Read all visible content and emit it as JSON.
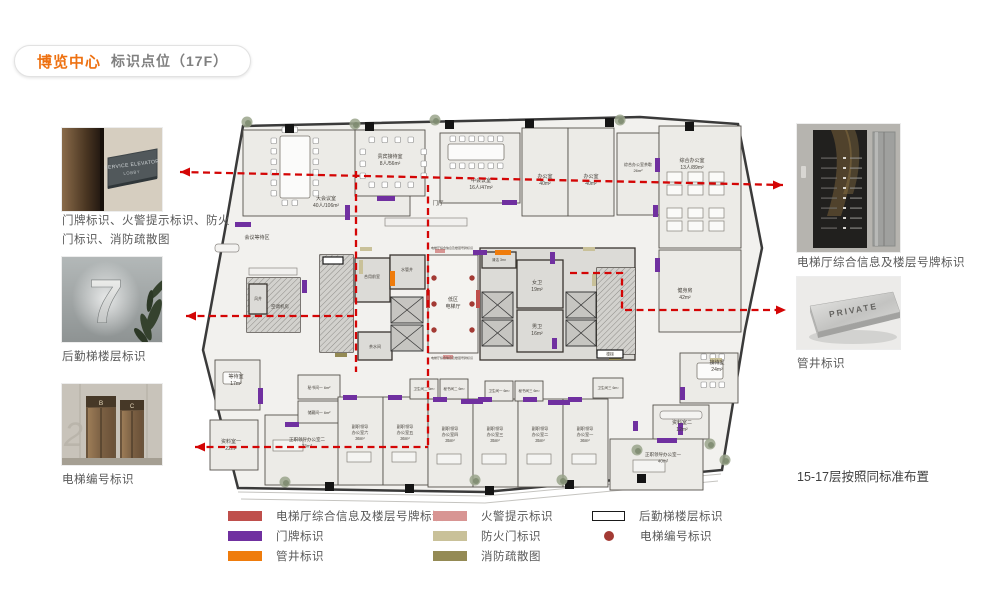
{
  "title": {
    "brand": "博览中心",
    "subtitle": "标识点位（17F）"
  },
  "left_column": [
    {
      "caption": "门牌标识、火警提示标识、防火门标识、消防疏散图"
    },
    {
      "caption": "后勤梯楼层标识"
    },
    {
      "caption": "电梯编号标识"
    }
  ],
  "right_column": {
    "items": [
      {
        "caption": "电梯厅综合信息及楼层号牌标识"
      },
      {
        "caption": "管井标识"
      }
    ],
    "note": "15-17层按照同标准布置"
  },
  "photos": {
    "p1": {
      "sign_line1": "SERVICE ELEVATOR",
      "sign_line2": "LOBBY"
    },
    "p2": {
      "numeral": "7"
    },
    "p3": {
      "left_door": "B",
      "right_door": "C",
      "wall_numeral": "2"
    },
    "r2": {
      "plate": "PRIVATE"
    }
  },
  "colors": {
    "purple": "#7030a0",
    "orange": "#ef7c0c",
    "pink": "#d89593",
    "khaki": "#c9c199",
    "olive": "#948a54",
    "red": "#bf4f4c",
    "dot": "#a33a34",
    "line": "#d40505",
    "wall": "#3a3a3a",
    "roomfill": "#ecebe7",
    "corefill": "#dcdbd7",
    "labeltext": "#46423c"
  },
  "legend": {
    "columns": [
      [
        {
          "type": "rect",
          "color": "#bf4f4c",
          "label": "电梯厅综合信息及楼层号牌标识"
        },
        {
          "type": "rect",
          "color": "#7030a0",
          "label": "门牌标识"
        },
        {
          "type": "rect",
          "color": "#ef7c0c",
          "label": "管井标识"
        }
      ],
      [
        {
          "type": "rect",
          "color": "#d89593",
          "label": "火警提示标识"
        },
        {
          "type": "rect",
          "color": "#c9c199",
          "label": "防火门标识"
        },
        {
          "type": "rect",
          "color": "#948a54",
          "label": "消防疏散图"
        }
      ],
      [
        {
          "type": "outline",
          "color": "#ffffff",
          "label": "后勤梯楼层标识"
        },
        {
          "type": "dot",
          "color": "#a33a34",
          "label": "电梯编号标识"
        }
      ]
    ],
    "col_left": [
      228,
      433,
      592
    ]
  },
  "floorplan": {
    "outline": "58,18 455,9 553,16 577,140 560,222 537,362 300,384 53,380 18,242 40,122",
    "extras": [
      "M53,384 L300,388 L536,366",
      "M56,391 L300,395 L533,373"
    ],
    "rooms": [
      {
        "x": 58,
        "y": 22,
        "w": 167,
        "h": 86,
        "lines": [
          "大会议室",
          "40人/106m²"
        ],
        "lx": 141,
        "ly": 92
      },
      {
        "x": 170,
        "y": 22,
        "w": 70,
        "h": 66,
        "lines": [
          "贵宾接待室",
          "8人/56m²"
        ],
        "lx": 205,
        "ly": 50
      },
      {
        "x": 255,
        "y": 25,
        "w": 80,
        "h": 70,
        "lines": [
          "中会议室",
          "16人/47m²"
        ],
        "lx": 296,
        "ly": 74
      },
      {
        "x": 337,
        "y": 20,
        "w": 46,
        "h": 88,
        "lines": [
          "办公室",
          "40m²"
        ],
        "lx": 360,
        "ly": 70
      },
      {
        "x": 383,
        "y": 20,
        "w": 46,
        "h": 88,
        "lines": [
          "办公室",
          "40m²"
        ],
        "lx": 406,
        "ly": 70
      },
      {
        "x": 432,
        "y": 25,
        "w": 42,
        "h": 82,
        "lines": [
          "综合办公室茶歇",
          "26m²"
        ],
        "lx": 453,
        "ly": 58,
        "fs": 4
      },
      {
        "x": 474,
        "y": 18,
        "w": 82,
        "h": 122,
        "lines": [
          "综合办公室",
          "13人/89m²"
        ],
        "lx": 507,
        "ly": 54
      },
      {
        "x": 474,
        "y": 142,
        "w": 82,
        "h": 82,
        "lines": [
          "健身房",
          "42m²"
        ],
        "lx": 500,
        "ly": 184
      },
      {
        "x": 495,
        "y": 245,
        "w": 58,
        "h": 50,
        "lines": [
          "接待室",
          "24m²"
        ],
        "lx": 532,
        "ly": 256
      },
      {
        "x": 468,
        "y": 297,
        "w": 56,
        "h": 34,
        "lines": [
          "资料室二",
          "12m²"
        ],
        "lx": 497,
        "ly": 316
      },
      {
        "x": 425,
        "y": 331,
        "w": 93,
        "h": 51,
        "lines": [
          "正职领导办公室一",
          "40m²"
        ],
        "lx": 478,
        "ly": 348,
        "fs": 4.5
      },
      {
        "x": 80,
        "y": 307,
        "w": 90,
        "h": 70,
        "lines": [
          "正职领导办公室二",
          "73m²"
        ],
        "lx": 122,
        "ly": 333,
        "fs": 4.5
      },
      {
        "x": 25,
        "y": 312,
        "w": 48,
        "h": 50,
        "lines": [
          "资料室一",
          "22m²"
        ],
        "lx": 46,
        "ly": 335
      },
      {
        "x": 30,
        "y": 252,
        "w": 45,
        "h": 50,
        "lines": [
          "等待室",
          "17m²"
        ],
        "lx": 51,
        "ly": 270
      },
      {
        "x": 113,
        "y": 267,
        "w": 42,
        "h": 24,
        "lines": [
          "秘书间一 6m²"
        ],
        "lx": 134,
        "ly": 281,
        "fs": 3.8
      },
      {
        "x": 113,
        "y": 293,
        "w": 42,
        "h": 22,
        "lines": [
          "储藏间一 6m²"
        ],
        "lx": 134,
        "ly": 306,
        "fs": 3.8
      },
      {
        "x": 153,
        "y": 289,
        "w": 45,
        "h": 88,
        "lines": [
          "副职领导",
          "办公室六",
          "36m²"
        ],
        "lx": 175,
        "ly": 320,
        "fs": 4.2
      },
      {
        "x": 198,
        "y": 289,
        "w": 45,
        "h": 88,
        "lines": [
          "副职领导",
          "办公室五",
          "36m²"
        ],
        "lx": 220,
        "ly": 320,
        "fs": 4.2
      },
      {
        "x": 243,
        "y": 291,
        "w": 45,
        "h": 88,
        "lines": [
          "副职领导",
          "办公室四",
          "35m²"
        ],
        "lx": 265,
        "ly": 322,
        "fs": 4.2
      },
      {
        "x": 288,
        "y": 291,
        "w": 45,
        "h": 88,
        "lines": [
          "副职领导",
          "办公室三",
          "35m²"
        ],
        "lx": 310,
        "ly": 322,
        "fs": 4.2
      },
      {
        "x": 333,
        "y": 291,
        "w": 45,
        "h": 88,
        "lines": [
          "副职领导",
          "办公室二",
          "35m²"
        ],
        "lx": 355,
        "ly": 322,
        "fs": 4.2
      },
      {
        "x": 378,
        "y": 291,
        "w": 45,
        "h": 88,
        "lines": [
          "副职领导",
          "办公室一",
          "36m²"
        ],
        "lx": 400,
        "ly": 322,
        "fs": 4.2
      },
      {
        "x": 225,
        "y": 271,
        "w": 28,
        "h": 20,
        "lines": [
          "卫生间二 6m²"
        ],
        "lx": 239,
        "ly": 282,
        "fs": 3.5
      },
      {
        "x": 255,
        "y": 271,
        "w": 28,
        "h": 20,
        "lines": [
          "秘书间二 6m²"
        ],
        "lx": 269,
        "ly": 282,
        "fs": 3.5
      },
      {
        "x": 300,
        "y": 273,
        "w": 28,
        "h": 20,
        "lines": [
          "卫生间一 6m²"
        ],
        "lx": 314,
        "ly": 284,
        "fs": 3.5
      },
      {
        "x": 330,
        "y": 273,
        "w": 28,
        "h": 20,
        "lines": [
          "秘书间三 6m²"
        ],
        "lx": 344,
        "ly": 284,
        "fs": 3.5
      },
      {
        "x": 408,
        "y": 270,
        "w": 30,
        "h": 20,
        "lines": [
          "卫生间三 6m²"
        ],
        "lx": 423,
        "ly": 281,
        "fs": 3.5
      },
      {
        "x": 62,
        "y": 170,
        "w": 53,
        "h": 54,
        "core": true,
        "hatch": true,
        "lines": [
          "空调机房"
        ],
        "lx": 95,
        "ly": 200,
        "fs": 4.5
      },
      {
        "x": 64,
        "y": 176,
        "w": 18,
        "h": 30,
        "core": true,
        "lines": [
          "风井"
        ],
        "lx": 73,
        "ly": 192,
        "fs": 3.8
      },
      {
        "x": 135,
        "y": 147,
        "w": 33,
        "h": 97,
        "core": true,
        "hatch": true
      },
      {
        "x": 170,
        "y": 150,
        "w": 35,
        "h": 44,
        "core": true,
        "lines": [
          "合用前室"
        ],
        "lx": 187,
        "ly": 170,
        "fs": 4
      },
      {
        "x": 205,
        "y": 147,
        "w": 35,
        "h": 34,
        "core": true,
        "lines": [
          "水管井"
        ],
        "lx": 222,
        "ly": 163,
        "fs": 4
      },
      {
        "x": 173,
        "y": 224,
        "w": 34,
        "h": 28,
        "core": true,
        "lines": [
          "茶水间"
        ],
        "lx": 190,
        "ly": 240,
        "fs": 4
      },
      {
        "x": 243,
        "y": 147,
        "w": 50,
        "h": 98,
        "hall": true,
        "lines": [
          "低区",
          "电梯厅"
        ],
        "lx": 268,
        "ly": 193
      },
      {
        "x": 295,
        "y": 140,
        "w": 155,
        "h": 112,
        "core": true
      },
      {
        "x": 297,
        "y": 144,
        "w": 34,
        "h": 16,
        "core": true,
        "lines": [
          "清洁 3m²"
        ],
        "lx": 314,
        "ly": 153,
        "fs": 3.5
      },
      {
        "x": 332,
        "y": 152,
        "w": 46,
        "h": 48,
        "core": true,
        "lines": [
          "女卫",
          "19m²"
        ],
        "lx": 352,
        "ly": 176
      },
      {
        "x": 332,
        "y": 202,
        "w": 46,
        "h": 42,
        "core": true,
        "lines": [
          "男卫",
          "16m²"
        ],
        "lx": 352,
        "ly": 220
      },
      {
        "x": 412,
        "y": 160,
        "w": 38,
        "h": 86,
        "core": true,
        "hatch": true
      }
    ],
    "labels": [
      {
        "x": 253,
        "y": 97,
        "t": "门厅",
        "s": 5.5
      },
      {
        "x": 72,
        "y": 131,
        "t": "会议等待区",
        "s": 5
      },
      {
        "x": 267,
        "y": 141,
        "t": "电梯厅综合信息及楼层号牌标识",
        "s": 3
      },
      {
        "x": 267,
        "y": 251,
        "t": "电梯厅综合信息及楼层号牌标识",
        "s": 3
      },
      {
        "x": 425,
        "y": 247.5,
        "t": "楼梯",
        "s": 3.8
      }
    ],
    "shafts": [
      [
        206,
        189,
        32,
        26
      ],
      [
        206,
        217,
        32,
        26
      ],
      [
        297,
        184,
        31,
        26
      ],
      [
        297,
        212,
        31,
        26
      ],
      [
        381,
        184,
        30,
        26
      ],
      [
        381,
        212,
        30,
        26
      ]
    ],
    "white_markers": [
      [
        138,
        149,
        20,
        7
      ],
      [
        412,
        242,
        26,
        8
      ]
    ],
    "markers": {
      "purple": [
        [
          192,
          88,
          18,
          5
        ],
        [
          50,
          114,
          16,
          5
        ],
        [
          160,
          97,
          5,
          15
        ],
        [
          317,
          92,
          15,
          5
        ],
        [
          470,
          50,
          5,
          14
        ],
        [
          468,
          97,
          5,
          12
        ],
        [
          470,
          150,
          5,
          14
        ],
        [
          288,
          142,
          14,
          5
        ],
        [
          117,
          172,
          5,
          13
        ],
        [
          365,
          144,
          5,
          12
        ],
        [
          367,
          230,
          5,
          11
        ],
        [
          73,
          280,
          5,
          16
        ],
        [
          100,
          314,
          14,
          5
        ],
        [
          158,
          287,
          14,
          5
        ],
        [
          203,
          287,
          14,
          5
        ],
        [
          248,
          289,
          14,
          5
        ],
        [
          293,
          289,
          14,
          5
        ],
        [
          338,
          289,
          14,
          5
        ],
        [
          383,
          289,
          14,
          5
        ],
        [
          276,
          291,
          22,
          5
        ],
        [
          363,
          292,
          22,
          5
        ],
        [
          495,
          279,
          5,
          13
        ],
        [
          472,
          330,
          20,
          5
        ],
        [
          493,
          315,
          5,
          12
        ],
        [
          448,
          313,
          5,
          10
        ]
      ],
      "orange": [
        [
          310,
          142,
          16,
          5
        ],
        [
          205,
          163,
          5,
          15
        ]
      ],
      "pink": [
        [
          250,
          141,
          10,
          4
        ],
        [
          258,
          247,
          10,
          4
        ]
      ],
      "khaki": [
        [
          174,
          152,
          4,
          14
        ],
        [
          407,
          166,
          4,
          12
        ],
        [
          175,
          139,
          12,
          4
        ],
        [
          398,
          139,
          12,
          4
        ],
        [
          525,
          250,
          12,
          4
        ]
      ],
      "olive": [
        [
          150,
          245,
          12,
          4
        ],
        [
          424,
          248,
          12,
          4
        ]
      ],
      "red": [
        [
          241,
          182,
          4,
          18
        ],
        [
          291,
          182,
          4,
          18
        ]
      ]
    },
    "dots": [
      [
        249,
        170
      ],
      [
        249,
        196
      ],
      [
        249,
        222
      ],
      [
        287,
        170
      ],
      [
        287,
        196
      ],
      [
        287,
        222
      ]
    ],
    "columns": [
      [
        100,
        16
      ],
      [
        180,
        14
      ],
      [
        260,
        12
      ],
      [
        340,
        11
      ],
      [
        420,
        10
      ],
      [
        500,
        14
      ],
      [
        140,
        374
      ],
      [
        220,
        376
      ],
      [
        300,
        378
      ],
      [
        380,
        372
      ],
      [
        452,
        366
      ]
    ],
    "trees": [
      [
        62,
        14
      ],
      [
        170,
        16
      ],
      [
        250,
        12
      ],
      [
        435,
        12
      ],
      [
        100,
        374
      ],
      [
        290,
        372
      ],
      [
        377,
        372
      ],
      [
        540,
        352
      ],
      [
        525,
        336
      ],
      [
        452,
        342
      ]
    ],
    "furniture": {
      "tables": [
        [
          95,
          28,
          30,
          62
        ],
        [
          263,
          36,
          56,
          16
        ],
        [
          512,
          255,
          26,
          16
        ],
        [
          38,
          264,
          18,
          12
        ]
      ],
      "counters": [
        [
          200,
          110,
          82,
          8
        ],
        [
          64,
          160,
          48,
          7
        ]
      ],
      "desks": [
        [
          88,
          332,
          30,
          11
        ],
        [
          162,
          344,
          24,
          10
        ],
        [
          207,
          344,
          24,
          10
        ],
        [
          252,
          346,
          24,
          10
        ],
        [
          297,
          346,
          24,
          10
        ],
        [
          342,
          346,
          24,
          10
        ],
        [
          387,
          346,
          24,
          10
        ],
        [
          448,
          352,
          32,
          12
        ]
      ],
      "sofas": [
        [
          475,
          303,
          42,
          8
        ],
        [
          30,
          136,
          24,
          8
        ]
      ],
      "chair_runs": [
        {
          "x": 86,
          "y": 30,
          "dx": 0,
          "dy": 10.5,
          "n": 6
        },
        {
          "x": 128,
          "y": 30,
          "dx": 0,
          "dy": 10.5,
          "n": 6
        },
        {
          "x": 97,
          "y": 19,
          "dx": 10,
          "dy": 0,
          "n": 2
        },
        {
          "x": 97,
          "y": 92,
          "dx": 10,
          "dy": 0,
          "n": 2
        },
        {
          "x": 265,
          "y": 28,
          "dx": 9.5,
          "dy": 0,
          "n": 6
        },
        {
          "x": 265,
          "y": 55,
          "dx": 9.5,
          "dy": 0,
          "n": 6
        },
        {
          "x": 184,
          "y": 29,
          "dx": 13,
          "dy": 0,
          "n": 4
        },
        {
          "x": 184,
          "y": 74,
          "dx": 13,
          "dy": 0,
          "n": 4
        },
        {
          "x": 175,
          "y": 41,
          "dx": 0,
          "dy": 12,
          "n": 3
        },
        {
          "x": 236,
          "y": 41,
          "dx": 0,
          "dy": 12,
          "n": 3
        },
        {
          "x": 516,
          "y": 246,
          "dx": 9,
          "dy": 0,
          "n": 3
        },
        {
          "x": 516,
          "y": 274,
          "dx": 9,
          "dy": 0,
          "n": 3
        }
      ],
      "desk_grids": [
        {
          "x": 482,
          "y": 64,
          "cols": 3,
          "rows": 2,
          "w": 15,
          "h": 10,
          "gx": 21,
          "gy": 13
        },
        {
          "x": 482,
          "y": 100,
          "cols": 3,
          "rows": 2,
          "w": 15,
          "h": 10,
          "gx": 21,
          "gy": 13
        }
      ]
    }
  },
  "annotations": {
    "dashes": [
      "M180,172 L783,185",
      "M186,316 L356,316",
      "M356,171 L356,372",
      "M428,185 L428,447",
      "M195,447 L428,447",
      "M570,273 L622,273 L622,310 L786,310"
    ],
    "arrows": [
      {
        "x": 180,
        "y": 172,
        "dir": "left"
      },
      {
        "x": 783,
        "y": 185,
        "dir": "right"
      },
      {
        "x": 186,
        "y": 316,
        "dir": "left"
      },
      {
        "x": 195,
        "y": 447,
        "dir": "left"
      },
      {
        "x": 786,
        "y": 310,
        "dir": "right"
      }
    ]
  }
}
